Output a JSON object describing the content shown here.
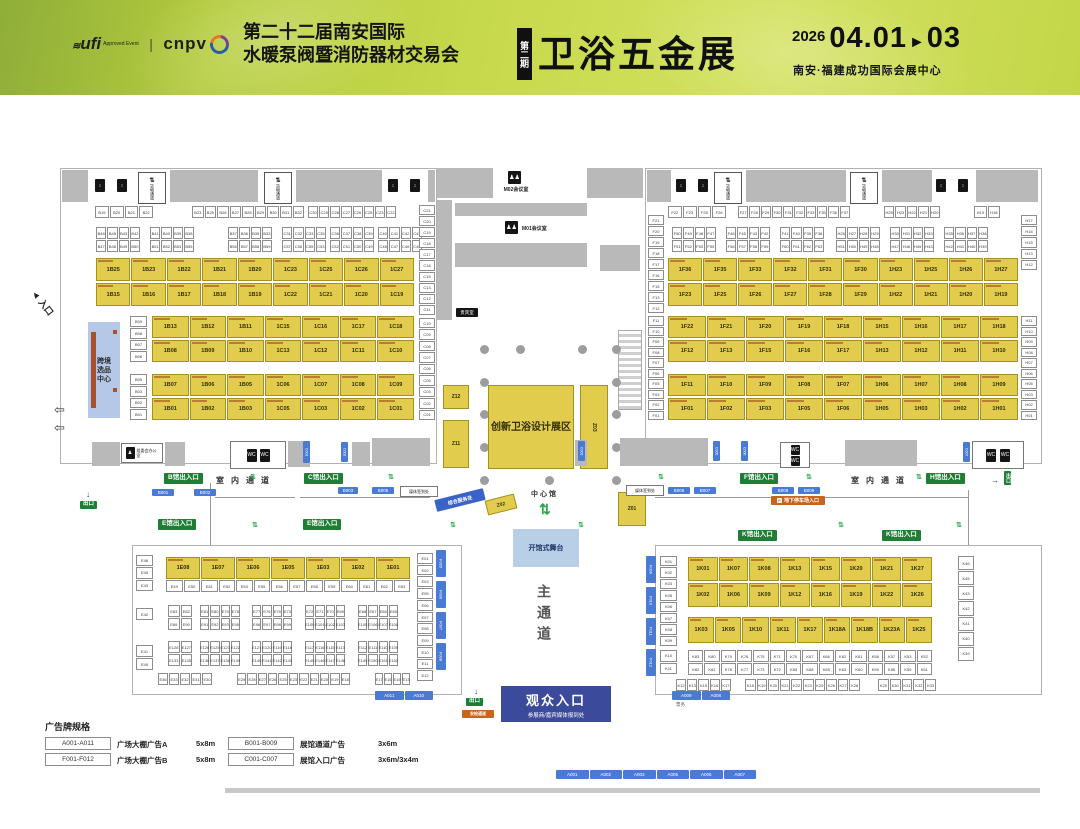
{
  "header": {
    "ufi_logo": "ufi",
    "ufi_sub": "Approved Event",
    "cnpv_logo": "cnpv",
    "title_line1": "第二十二届南安国际",
    "title_line2": "水暖泵阀暨消防器材交易会",
    "phase_badge": "第二期",
    "expo_name": "卫浴五金展",
    "year": "2026",
    "date_start": "04.01",
    "date_arrow": "►",
    "date_end": "03",
    "venue": "南安·福建成功国际会展中心"
  },
  "labels": {
    "cargo_channel": "货物通道",
    "meeting_m02": "M02会议室",
    "meeting_m01": "M01会议室",
    "vip_room": "贵宾室",
    "committee_office": "组委会办公室",
    "indoor_aisle": "室内通道",
    "center_hall": "中心馆",
    "main_aisle": "主通道",
    "entrance_b": "B馆出入口",
    "entrance_c": "C馆出入口",
    "entrance_e": "E馆出入口",
    "entrance_f": "F馆出入口",
    "entrance_h": "H馆出入口",
    "entrance_k": "K馆出入口",
    "exit": "出口",
    "security": "安检通道",
    "media_checkin": "媒体签到处",
    "parking": "地下停车场入口",
    "service_desk": "综合服务处",
    "design_zone": "创新卫浴设计展区",
    "crossborder": "跨境选品中心",
    "stage": "开馆式舞台",
    "audience_entrance": "观众入口",
    "audience_sub": "参展商/嘉宾媒体报到处",
    "ticket": "票务",
    "entry_arrow": "入口"
  },
  "icons": {
    "elevator": "↕",
    "restroom": "WC",
    "meeting": "♟♟",
    "people": "♟",
    "cargo": "⇅",
    "parking": "P",
    "flow": "⇅",
    "down": "↓",
    "right": "→",
    "exit_arrow": "⇦",
    "entry": "◄"
  },
  "center": {
    "z12": "Z12",
    "z11": "Z11",
    "z03": "Z03",
    "z02": "Z02",
    "z01": "Z01"
  },
  "halls": {
    "bc": {
      "sr1a": [
        "B19",
        "B20",
        "B21",
        "B22"
      ],
      "sr1b": [
        "B23",
        "B25",
        "B26",
        "B27",
        "B28",
        "B29",
        "B30",
        "B31",
        "B32"
      ],
      "sr1c": [
        "C30",
        "C29",
        "C28",
        "C27",
        "C26",
        "C25",
        "C23",
        "C22"
      ],
      "g1t": [
        "B46",
        "B45",
        "B43",
        "B42"
      ],
      "g1b": [
        "B47",
        "B48",
        "B49",
        "B50"
      ],
      "g2t": [
        "B41",
        "B40",
        "B39",
        "B38"
      ],
      "g2b": [
        "B51",
        "B52",
        "B53",
        "B55"
      ],
      "g3t": [
        "B37",
        "B36",
        "B35",
        "B33"
      ],
      "g3b": [
        "B56",
        "B57",
        "B58",
        "B59"
      ],
      "g4t": [
        "C31",
        "C32",
        "C33",
        "C35"
      ],
      "g4b": [
        "C57",
        "C56",
        "C55",
        "C53"
      ],
      "g5t": [
        "C36",
        "C37",
        "C38",
        "C39"
      ],
      "g5b": [
        "C52",
        "C51",
        "C50",
        "C49"
      ],
      "g6t": [
        "C40",
        "C41",
        "C42",
        "C43"
      ],
      "g6b": [
        "C48",
        "C47",
        "C46",
        "C45"
      ],
      "yr1": [
        "1B25",
        "1B23",
        "1B22",
        "1B21",
        "1B20",
        "1C23",
        "1C25",
        "1C26",
        "1C27"
      ],
      "yr2": [
        "1B15",
        "1B16",
        "1B17",
        "1B18",
        "1B19",
        "1C22",
        "1C21",
        "1C20",
        "1C19"
      ],
      "yr3": [
        "1B13",
        "1B12",
        "1B11",
        "1C15",
        "1C16",
        "1C17",
        "1C18"
      ],
      "yr4": [
        "1B08",
        "1B09",
        "1B10",
        "1C13",
        "1C12",
        "1C11",
        "1C10"
      ],
      "yr5": [
        "1B07",
        "1B06",
        "1B05",
        "1C06",
        "1C07",
        "1C08",
        "1C09"
      ],
      "yr6": [
        "1B01",
        "1B02",
        "1B03",
        "1C05",
        "1C03",
        "1C02",
        "1C01"
      ],
      "bcol1": [
        "B09",
        "B08",
        "B07",
        "B06"
      ],
      "bcol2": [
        "B05",
        "B03",
        "B02",
        "B01"
      ],
      "ccol_top": [
        "C21",
        "C20",
        "C19",
        "C18",
        "C17",
        "C16",
        "C15",
        "C13",
        "C12",
        "C11"
      ],
      "ccol_bot": [
        "C10",
        "C09",
        "C08",
        "C07",
        "C06",
        "C05",
        "C03",
        "C02",
        "C01"
      ]
    },
    "fh": {
      "sr1a": [
        "F22",
        "F23",
        "F25",
        "F26"
      ],
      "sr1b": [
        "F27",
        "F28",
        "F29",
        "F30",
        "F31",
        "F32",
        "F33",
        "F35",
        "F36",
        "F37"
      ],
      "sr1c": [
        "H25",
        "H23",
        "H22",
        "H21",
        "H20"
      ],
      "sr1d": [
        "H19",
        "H18"
      ],
      "g1t": [
        "F50",
        "F49",
        "F48",
        "F47"
      ],
      "g1b": [
        "F51",
        "F52",
        "F53",
        "F55"
      ],
      "g2t": [
        "F46",
        "F45",
        "F43",
        "F42"
      ],
      "g2b": [
        "F56",
        "F57",
        "F58",
        "F59"
      ],
      "g3t": [
        "F41",
        "F40",
        "F39",
        "F38"
      ],
      "g3b": [
        "F60",
        "F61",
        "F62",
        "F63"
      ],
      "g4t": [
        "H26",
        "H27",
        "H28",
        "H29"
      ],
      "g4b": [
        "H51",
        "H50",
        "H49",
        "H48"
      ],
      "g5t": [
        "H30",
        "H31",
        "H32",
        "H33"
      ],
      "g5b": [
        "H47",
        "H46",
        "H45",
        "H43"
      ],
      "g6t": [
        "H35",
        "H36",
        "H37",
        "H38"
      ],
      "g6b": [
        "H42",
        "H41",
        "H40",
        "H39"
      ],
      "yr1": [
        "1F36",
        "1F35",
        "1F33",
        "1F32",
        "1F31",
        "1F30",
        "1H23",
        "1H25",
        "1H26",
        "1H27"
      ],
      "yr2": [
        "1F23",
        "1F25",
        "1F26",
        "1F27",
        "1F28",
        "1F29",
        "1H22",
        "1H21",
        "1H20",
        "1H19"
      ],
      "yr3": [
        "1F22",
        "1F21",
        "1F20",
        "1F19",
        "1F18",
        "1H15",
        "1H16",
        "1H17",
        "1H18"
      ],
      "yr4": [
        "1F12",
        "1F13",
        "1F15",
        "1F16",
        "1F17",
        "1H13",
        "1H12",
        "1H11",
        "1H10"
      ],
      "yr5": [
        "1F11",
        "1F10",
        "1F09",
        "1F08",
        "1F07",
        "1H06",
        "1H07",
        "1H08",
        "1H09"
      ],
      "yr6": [
        "1F01",
        "1F02",
        "1F03",
        "1F05",
        "1F06",
        "1H05",
        "1H03",
        "1H02",
        "1H01"
      ],
      "fcol_top": [
        "F21",
        "F20",
        "F19",
        "F18",
        "F17",
        "F16",
        "F15",
        "F13",
        "F12"
      ],
      "fcol_bot": [
        "F11",
        "F10",
        "F09",
        "F08",
        "F07",
        "F06",
        "F05",
        "F03",
        "F02",
        "F01"
      ],
      "hcol_top": [
        "H17",
        "H16",
        "H15",
        "H13",
        "H12"
      ],
      "hcol_bot": [
        "H11",
        "H10",
        "H09",
        "H08",
        "H07",
        "H06",
        "H05",
        "H03",
        "H02",
        "H01"
      ]
    },
    "e": {
      "yrow": [
        "1E08",
        "1E07",
        "1E06",
        "1E05",
        "1E03",
        "1E02",
        "1E01"
      ],
      "subpairs": [
        "E49",
        "E50",
        "E51",
        "E52",
        "E53",
        "E55",
        "E56",
        "E57",
        "E58",
        "E59",
        "E60",
        "E61",
        "E62",
        "E63"
      ],
      "lcol_a": [
        "E46",
        "E45",
        "E43"
      ],
      "lcol_b": [
        "E42"
      ],
      "lcol_c": [
        "E41",
        "E40"
      ],
      "m1t": [
        "E83",
        "E82"
      ],
      "m1b": [
        "E89",
        "E90"
      ],
      "m2t": [
        "E81",
        "E80",
        "E79",
        "E78"
      ],
      "m2b": [
        "E91",
        "E92",
        "E93",
        "E95"
      ],
      "m3t": [
        "E77",
        "E76",
        "E75",
        "E73"
      ],
      "m3b": [
        "E96",
        "E97",
        "E98",
        "E99"
      ],
      "m4t": [
        "E72",
        "E71",
        "E70",
        "E69"
      ],
      "m4b": [
        "E100",
        "E101",
        "E102",
        "E103"
      ],
      "m5t": [
        "E68",
        "E67",
        "E66",
        "E65"
      ],
      "m5b": [
        "E105",
        "E106",
        "E107",
        "E108"
      ],
      "l1t": [
        "E128",
        "E127"
      ],
      "l1b": [
        "E133",
        "E135"
      ],
      "l2t": [
        "E126",
        "E125",
        "E123",
        "E122"
      ],
      "l2b": [
        "E136",
        "E137",
        "E138",
        "E139"
      ],
      "l3t": [
        "E121",
        "E120",
        "E119",
        "E118"
      ],
      "l3b": [
        "E140",
        "E141",
        "E142",
        "E143"
      ],
      "l4t": [
        "E117",
        "E116",
        "E115",
        "E113"
      ],
      "l4b": [
        "E145",
        "E146",
        "E147",
        "E148"
      ],
      "l5t": [
        "E112",
        "E111",
        "E110",
        "E109"
      ],
      "l5b": [
        "E149",
        "E150",
        "E151",
        "E152"
      ],
      "bot1": [
        "E36",
        "E33",
        "E32",
        "E31",
        "E30"
      ],
      "bot2": [
        "E29",
        "E28",
        "E27",
        "E26",
        "E25",
        "E23",
        "E22",
        "E21",
        "E20",
        "E19",
        "E18"
      ],
      "bot3": [
        "E17",
        "E16",
        "E15",
        "E13"
      ],
      "rcol": [
        "E01",
        "E02",
        "E03",
        "E05",
        "E06",
        "E07",
        "E08",
        "E09",
        "E10",
        "E11",
        "E12"
      ]
    },
    "k": {
      "lcol": [
        "K01",
        "K02",
        "K03",
        "K05",
        "K06",
        "K07",
        "K08",
        "K09"
      ],
      "lpair": [
        "K10",
        "K11"
      ],
      "yr1": [
        "1K01",
        "1K07",
        "1K08",
        "1K13",
        "1K15",
        "1K20",
        "1K21",
        "1K27"
      ],
      "yr2": [
        "1K02",
        "1K06",
        "1K09",
        "1K12",
        "1K16",
        "1K19",
        "1K22",
        "1K26"
      ],
      "yr3": [
        "1K03",
        "1K05",
        "1K10",
        "1K11",
        "1K17",
        "1K18A",
        "1K18B",
        "1K23A",
        "1K25"
      ],
      "smt": [
        "K83",
        "K80",
        "K79",
        "K76",
        "K75",
        "K71",
        "K70",
        "K67",
        "K66",
        "K62",
        "K61",
        "K58",
        "K57",
        "K53",
        "K52"
      ],
      "smb": [
        "K82",
        "K81",
        "K78",
        "K77",
        "K73",
        "K72",
        "K69",
        "K68",
        "K65",
        "K63",
        "K60",
        "K59",
        "K56",
        "K55",
        "K51"
      ],
      "bot1": [
        "K12",
        "K13",
        "K15",
        "K16",
        "K17"
      ],
      "bot2": [
        "K18",
        "K19",
        "K20",
        "K21",
        "K22",
        "K23",
        "K25",
        "K26",
        "K27",
        "K28"
      ],
      "bot3": [
        "K29",
        "K30",
        "K31",
        "K32",
        "K33"
      ],
      "rcol": [
        "K46",
        "K45",
        "K43",
        "K42",
        "K41",
        "K40",
        "K39"
      ]
    }
  },
  "ads": {
    "bars_bottom": [
      "A001",
      "A002",
      "A003",
      "A005",
      "A006",
      "A007"
    ],
    "bars_k": [
      "A009",
      "A008"
    ],
    "bars_e": [
      "A011",
      "A010"
    ],
    "b_left": [
      "B001",
      "B002",
      "B003",
      "B005"
    ],
    "b_right": [
      "B006",
      "B007",
      "B008",
      "B009"
    ],
    "f_strips_e": [
      "F005",
      "F006",
      "F007",
      "F008"
    ],
    "f_strips_k": [
      "F009",
      "F010",
      "F011",
      "F012"
    ],
    "c_tags": [
      "C001",
      "C002",
      "C003",
      "C005",
      "C006",
      "C007"
    ]
  },
  "legend": {
    "title": "广告牌规格",
    "items": [
      {
        "code": "A001-A011",
        "desc": "广场大棚广告A",
        "size": "5x8m"
      },
      {
        "code": "F001-F012",
        "desc": "广场大棚广告B",
        "size": "5x8m"
      },
      {
        "code": "B001-B009",
        "desc": "展馆通道广告",
        "size": "3x6m"
      },
      {
        "code": "C001-C007",
        "desc": "展馆入口广告",
        "size": "3x6m/3x4m"
      }
    ]
  }
}
